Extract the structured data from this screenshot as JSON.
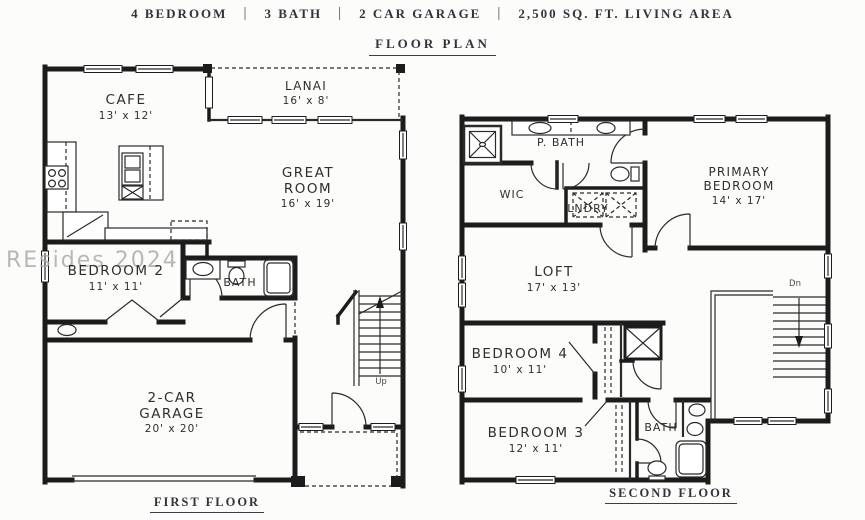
{
  "header": {
    "separator": "|",
    "specs": [
      "4 BEDROOM",
      "3 BATH",
      "2 CAR GARAGE",
      "2,500 SQ. FT. LIVING AREA"
    ],
    "title": "FLOOR PLAN"
  },
  "watermark": "REsides 2024",
  "first_floor": {
    "caption": "FIRST FLOOR",
    "stairs_label": "Up",
    "rooms": {
      "cafe": {
        "name": "CAFE",
        "dims": "13' x 12'"
      },
      "lanai": {
        "name": "LANAI",
        "dims": "16' x 8'"
      },
      "great_room": {
        "name": "GREAT ROOM",
        "dims": "16' x 19'"
      },
      "bedroom_2": {
        "name": "BEDROOM 2",
        "dims": "11' x 11'"
      },
      "bath": {
        "name": "BATH"
      },
      "garage": {
        "name": "2-CAR GARAGE",
        "dims": "20' x 20'"
      }
    }
  },
  "second_floor": {
    "caption": "SECOND FLOOR",
    "stairs_label": "Dn",
    "rooms": {
      "primary_bedroom": {
        "name": "PRIMARY BEDROOM",
        "dims": "14' x 17'"
      },
      "p_bath": {
        "name": "P. BATH"
      },
      "wic": {
        "name": "WIC"
      },
      "laundry": {
        "name": "LNDRY"
      },
      "loft": {
        "name": "LOFT",
        "dims": "17' x 13'"
      },
      "bedroom_4": {
        "name": "BEDROOM 4",
        "dims": "10' x 11'"
      },
      "bedroom_3": {
        "name": "BEDROOM 3",
        "dims": "12' x 11'"
      },
      "bath": {
        "name": "BATH"
      }
    }
  },
  "colors": {
    "wall": "#1c1c1c",
    "text": "#2f343b",
    "watermark": "#a9a9a9",
    "background": "#fcfcfa"
  }
}
